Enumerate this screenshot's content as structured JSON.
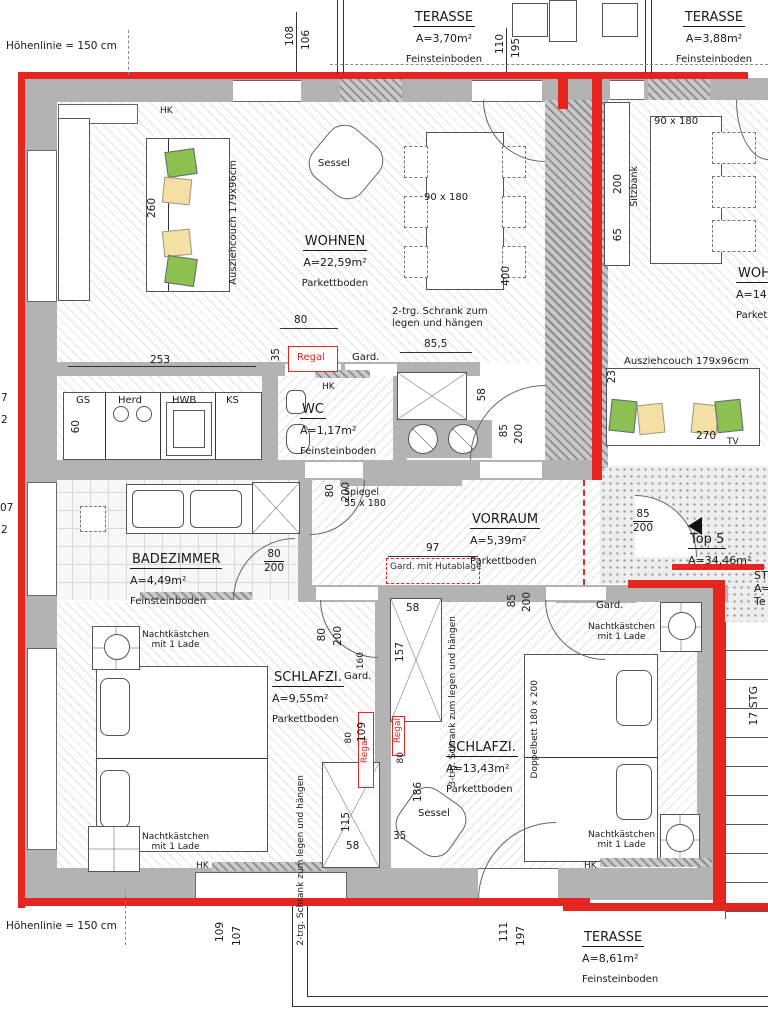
{
  "colors": {
    "outline_red": "#e52620",
    "wall_gray": "#b3b3b3",
    "pillow_green": "#8cc152",
    "pillow_yellow": "#f4e0a4"
  },
  "annotations": {
    "height_line_top": "Höhenlinie = 150 cm",
    "height_line_bottom": "Höhenlinie = 150 cm",
    "unit_label": "Top 5",
    "unit_area": "A=34,46m²",
    "stairs_label": "17 STG",
    "partial_right": {
      "l1": "ST",
      "l2": "A=",
      "l3": "Te"
    },
    "partial_left": {
      "a": "7",
      "b": "2",
      "c": "07",
      "d": "2"
    }
  },
  "rooms": {
    "wohnen": {
      "name": "WOHNEN",
      "area": "A=22,59m²",
      "floor": "Parkettboden"
    },
    "terr_top": {
      "name": "TERASSE",
      "area": "A=3,70m²",
      "floor": "Feinsteinboden"
    },
    "terr_r": {
      "name": "TERASSE",
      "area": "A=3,88m²",
      "floor": "Feinsteinboden"
    },
    "terr_b": {
      "name": "TERASSE",
      "area": "A=8,61m²",
      "floor": "Feinsteinboden"
    },
    "wc": {
      "name": "WC",
      "area": "A=1,17m²",
      "floor": "Feinsteinboden"
    },
    "vorraum": {
      "name": "VORRAUM",
      "area": "A=5,39m²",
      "floor": "Parkettboden"
    },
    "bad": {
      "name": "BADEZIMMER",
      "area": "A=4,49m²",
      "floor": "Feinsteinboden"
    },
    "schlaf_l": {
      "name": "SCHLAFZI.",
      "area": "A=9,55m²",
      "floor": "Parkettboden"
    },
    "schlaf_r": {
      "name": "SCHLAFZI.",
      "area": "A=13,43m²",
      "floor": "Parkettboden"
    },
    "wohnen_r": {
      "name": "WOH",
      "area": "A=14",
      "floor": "Parket"
    }
  },
  "furniture_labels": {
    "sessel": "Sessel",
    "ausziehcouch": "Ausziehcouch 179x96cm",
    "table": "90 x 180",
    "sitzbank": "Sitzbank",
    "spiegel_l1": "Spiegel",
    "spiegel_l2": "55 x 180",
    "gard": "Gard.",
    "gard_hut": "Gard. mit Hutablage",
    "regal": "Regal",
    "schrank2_l1": "2-trg. Schrank zum",
    "schrank2_l2": "legen und hängen",
    "schrank3_l1": "3-trg. Schrank zum",
    "schrank3_l2": "legen und hängen",
    "nacht_l1": "Nachtkästchen",
    "nacht_l2": "mit 1 Lade",
    "doppelbett": "Doppelbett 180 x 200",
    "gs": "GS",
    "herd": "Herd",
    "hwb": "HWB",
    "ks": "KS",
    "hk": "HK",
    "tv": "TV"
  },
  "dims": {
    "d108": "108",
    "d106": "106",
    "d110": "110",
    "d195": "195",
    "d253": "253",
    "d60": "60",
    "d80": "80",
    "d35": "35",
    "d855": "85,5",
    "d58": "58",
    "d400": "400",
    "d260": "260",
    "d200": "200",
    "d97": "97",
    "d85": "85",
    "d157": "157",
    "d160": "160",
    "d109": "109",
    "d115": "115",
    "d186": "186",
    "d270": "270",
    "d23": "23",
    "d65": "65",
    "d111": "111",
    "d197": "197",
    "d107": "107"
  }
}
